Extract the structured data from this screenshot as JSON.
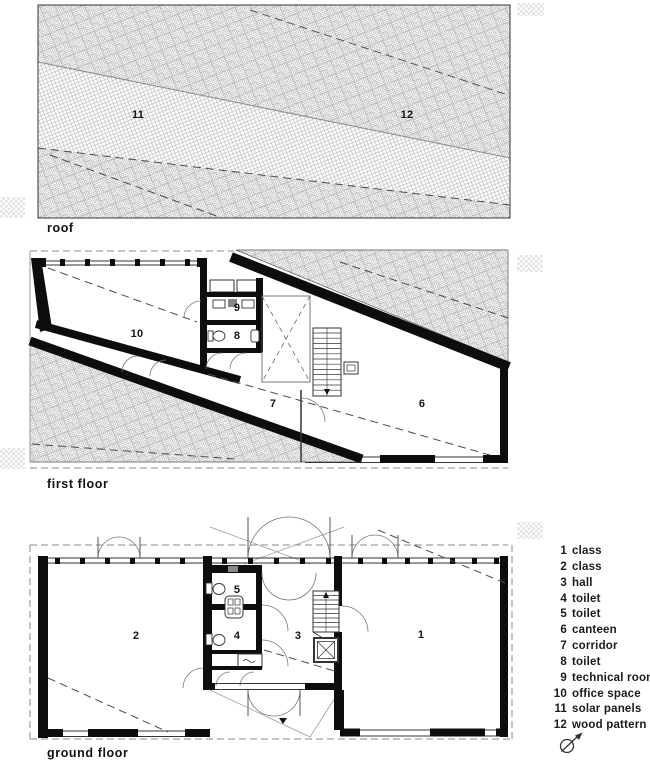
{
  "plans": {
    "roof": {
      "caption": "roof",
      "labels": {
        "solar": "11",
        "wood": "12"
      }
    },
    "first_floor": {
      "caption": "first floor",
      "rooms": {
        "r10": "10",
        "r9": "9",
        "r8": "8",
        "r7": "7",
        "r6": "6"
      }
    },
    "ground_floor": {
      "caption": "ground floor",
      "rooms": {
        "r1": "1",
        "r2": "2",
        "r3": "3",
        "r4": "4",
        "r5": "5"
      }
    }
  },
  "legend": {
    "items": [
      {
        "num": "1",
        "label": "class"
      },
      {
        "num": "2",
        "label": "class"
      },
      {
        "num": "3",
        "label": "hall"
      },
      {
        "num": "4",
        "label": "toilet"
      },
      {
        "num": "5",
        "label": "toilet"
      },
      {
        "num": "6",
        "label": "canteen"
      },
      {
        "num": "7",
        "label": "corridor"
      },
      {
        "num": "8",
        "label": "toilet"
      },
      {
        "num": "9",
        "label": "technical room"
      },
      {
        "num": "10",
        "label": "office space"
      },
      {
        "num": "11",
        "label": "solar panels"
      },
      {
        "num": "12",
        "label": "wood pattern"
      }
    ]
  },
  "icons": {
    "north_arrow": "compass-circle-with-needle"
  },
  "colors": {
    "wall": "#0d0d0d",
    "hatch_line": "#adadad",
    "dash_line": "#4a4a4a",
    "overhang_dash": "#8a8a8a",
    "swatch": "#e2e2e2",
    "background": "#ffffff"
  }
}
